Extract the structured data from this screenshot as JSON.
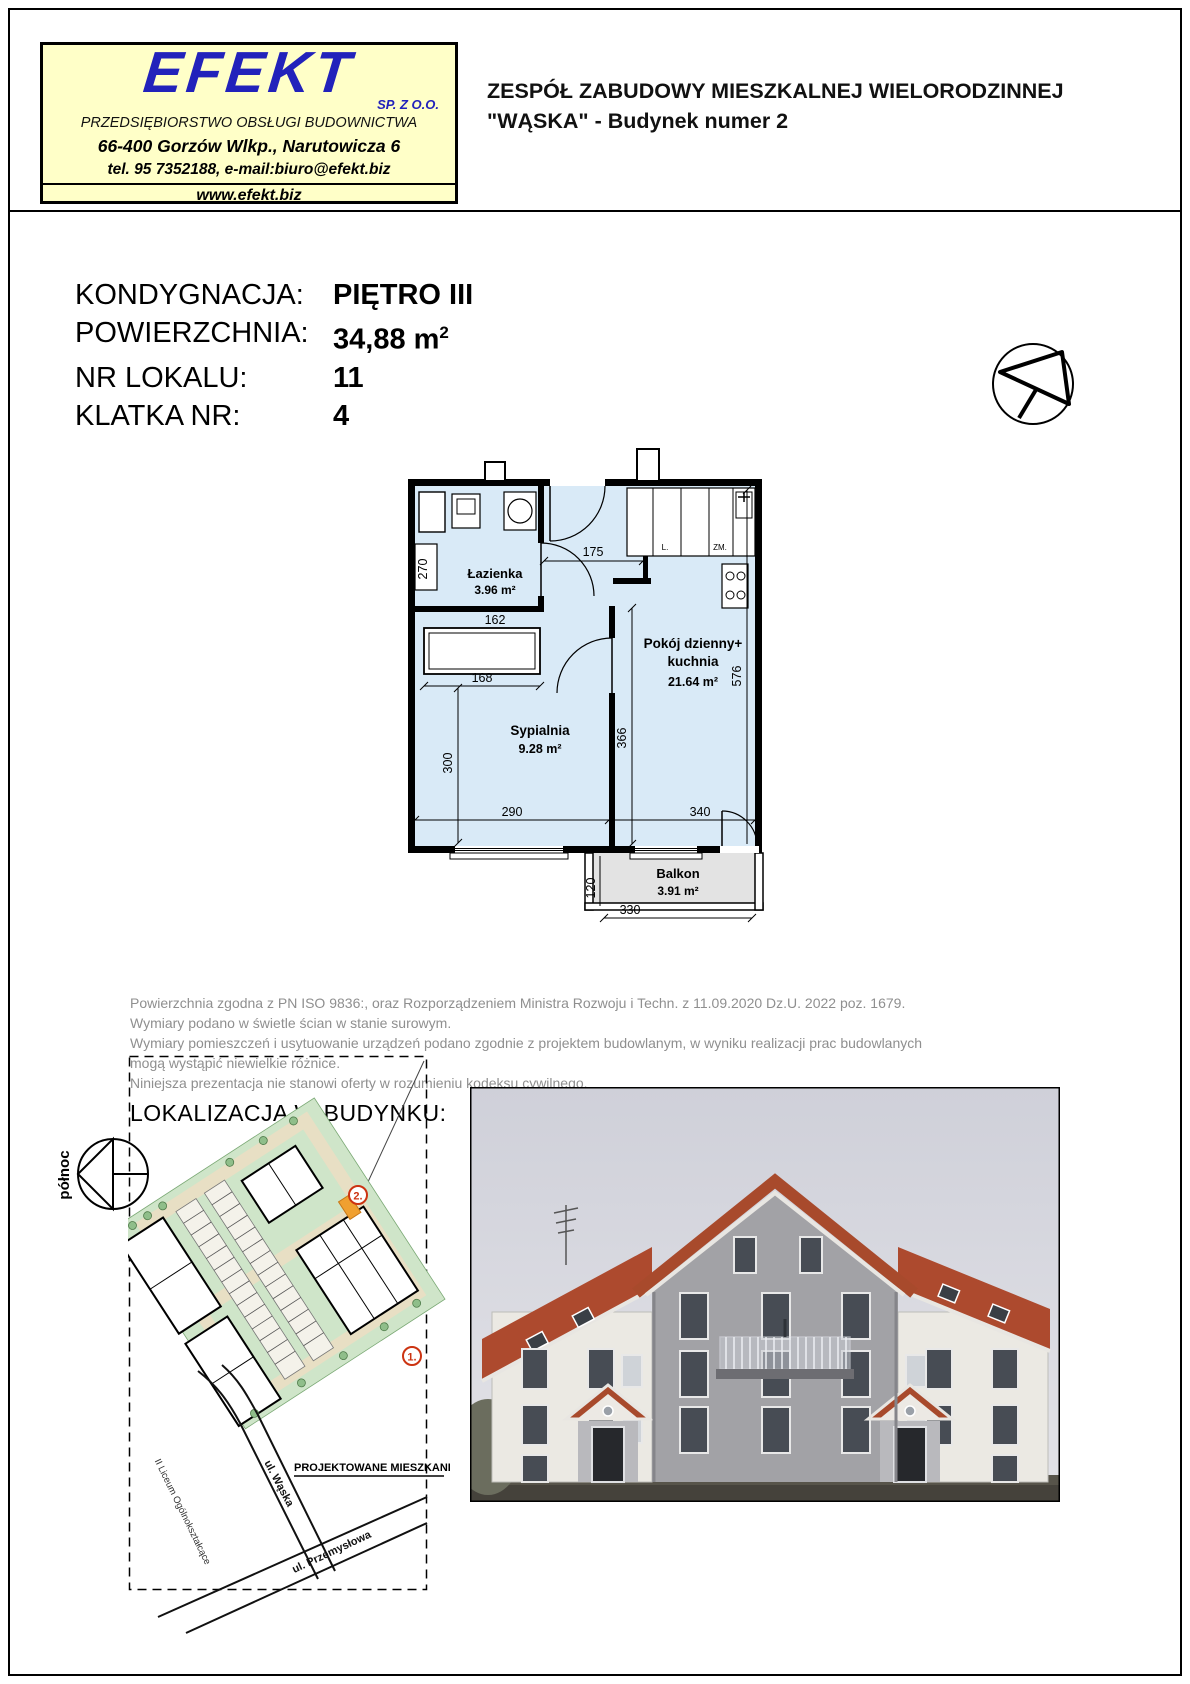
{
  "company": {
    "name": "EFEKT",
    "legal": "SP. Z  O.O.",
    "descriptor": "PRZEDSIĘBIORSTWO OBSŁUGI BUDOWNICTWA",
    "address": "66-400 Gorzów Wlkp., Narutowicza 6",
    "contact": "tel. 95 7352188, e-mail:biuro@efekt.biz",
    "website": "www.efekt.biz",
    "brand_color": "#2222bb",
    "box_bg": "#ffffc8"
  },
  "header": {
    "title_line1": "ZESPÓŁ ZABUDOWY MIESZKALNEJ WIELORODZINNEJ",
    "title_line2": "\"WĄSKA\" - Budynek numer 2"
  },
  "details": {
    "rows": [
      {
        "label": "KONDYGNACJA:",
        "value": "PIĘTRO III"
      },
      {
        "label": "POWIERZCHNIA:",
        "value": "34,88 m",
        "sup": "2"
      },
      {
        "label": "NR LOKALU:",
        "value": "11"
      },
      {
        "label": "KLATKA NR:",
        "value": "4"
      }
    ]
  },
  "floor_plan": {
    "fill_color": "#d9eaf7",
    "balcony_fill": "#e3e3e3",
    "rooms": {
      "bathroom": {
        "name": "Łazienka",
        "area": "3.96 m²"
      },
      "bedroom": {
        "name": "Sypialnia",
        "area": "9.28 m²"
      },
      "living": {
        "name_line1": "Pokój dzienny+",
        "name_line2": "kuchnia",
        "area": "21.64 m²"
      },
      "balcony": {
        "name": "Balkon",
        "area": "3.91 m²"
      }
    },
    "dims": {
      "hall": "175",
      "duct": "270",
      "bath_width": "162",
      "wardrobe": "168",
      "bedroom_depth": "300",
      "bedroom_width": "290",
      "living_depth": "366",
      "living_width": "340",
      "living_height": "576",
      "balcony_depth": "120",
      "balcony_width": "330"
    },
    "fixtures": {
      "fridge": "L.",
      "freezer": "ZM."
    }
  },
  "disclaimer": {
    "lines": [
      "Powierzchnia zgodna z PN ISO 9836:, oraz Rozporządzeniem Ministra Rozwoju i Techn. z 11.09.2020 Dz.U. 2022 poz. 1679.",
      "Wymiary podano w świetle ścian w stanie surowym.",
      "Wymiary pomieszczeń i usytuowanie urządzeń podano zgodnie z projektem budowlanym, w wyniku realizacji prac budowlanych",
      "mogą wystąpić niewielkie różnice.",
      "Niniejsza prezentacja nie stanowi oferty w rozumieniu kodeksu cywilnego."
    ]
  },
  "location": {
    "heading": "LOKALIZACJA W BUDYNKU:",
    "north_label": "północ",
    "site_plan": {
      "building1_marker": "1.",
      "building2_marker": "2.",
      "highlight_label": "PROJEKTOWANE MIESZKANIE",
      "street1": "ul. Wąska",
      "street2": "ul. Przemysłowa",
      "school_label": "II Liceum Ogólnokształcące"
    }
  }
}
